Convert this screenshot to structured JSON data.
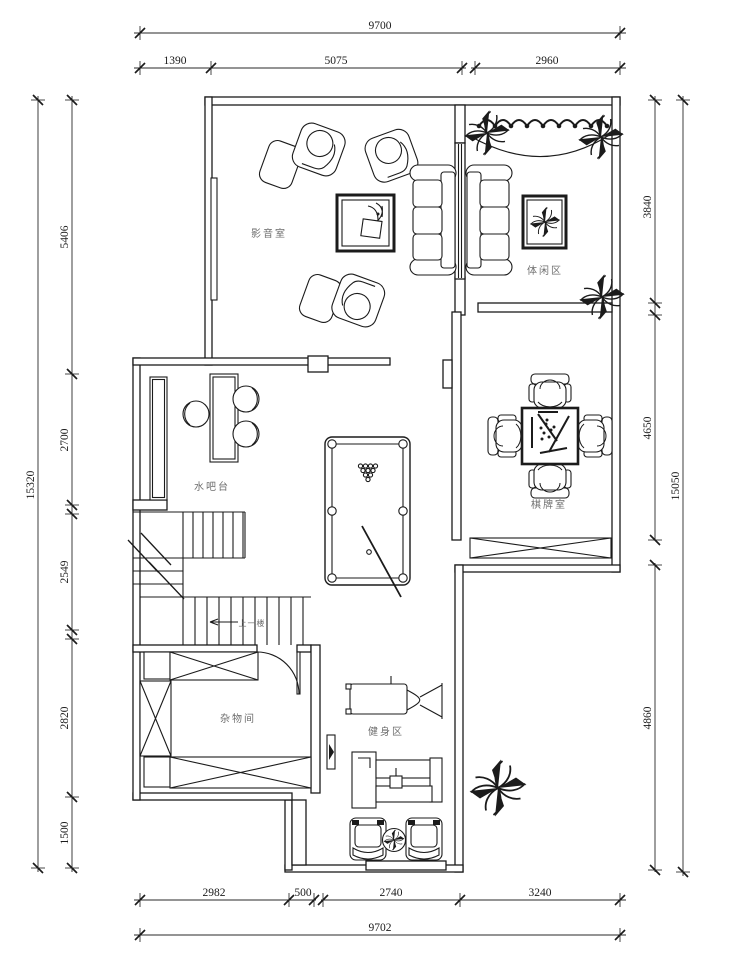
{
  "drawing": {
    "type": "floor-plan"
  },
  "colors": {
    "wall_line": "#1b1b1b",
    "dimension_line": "#2a2a2a",
    "dimension_text": "#1b1b1b",
    "room_label_text": "#6e6e6e",
    "background": "#ffffff"
  },
  "rooms": {
    "media_room": {
      "label": "影音室"
    },
    "leisure_area": {
      "label": "体闲区"
    },
    "water_bar": {
      "label": "水吧台"
    },
    "chess_room": {
      "label": "棋牌室"
    },
    "storage_room": {
      "label": "杂物间"
    },
    "fitness_area": {
      "label": "健身区"
    },
    "stairs_note": {
      "label": "上一楼"
    }
  },
  "dimensions": {
    "top": {
      "overall": "9700",
      "segments": [
        "1390",
        "5075",
        "2960"
      ]
    },
    "bottom": {
      "overall": "9702",
      "segments": [
        "2982",
        "500",
        "2740",
        "3240"
      ]
    },
    "left": {
      "overall": "15320",
      "segments": [
        "5406",
        "2700",
        "2549",
        "2820",
        "1500"
      ]
    },
    "right": {
      "overall": "15050",
      "segments": [
        "3840",
        "4650",
        "4860"
      ]
    }
  }
}
